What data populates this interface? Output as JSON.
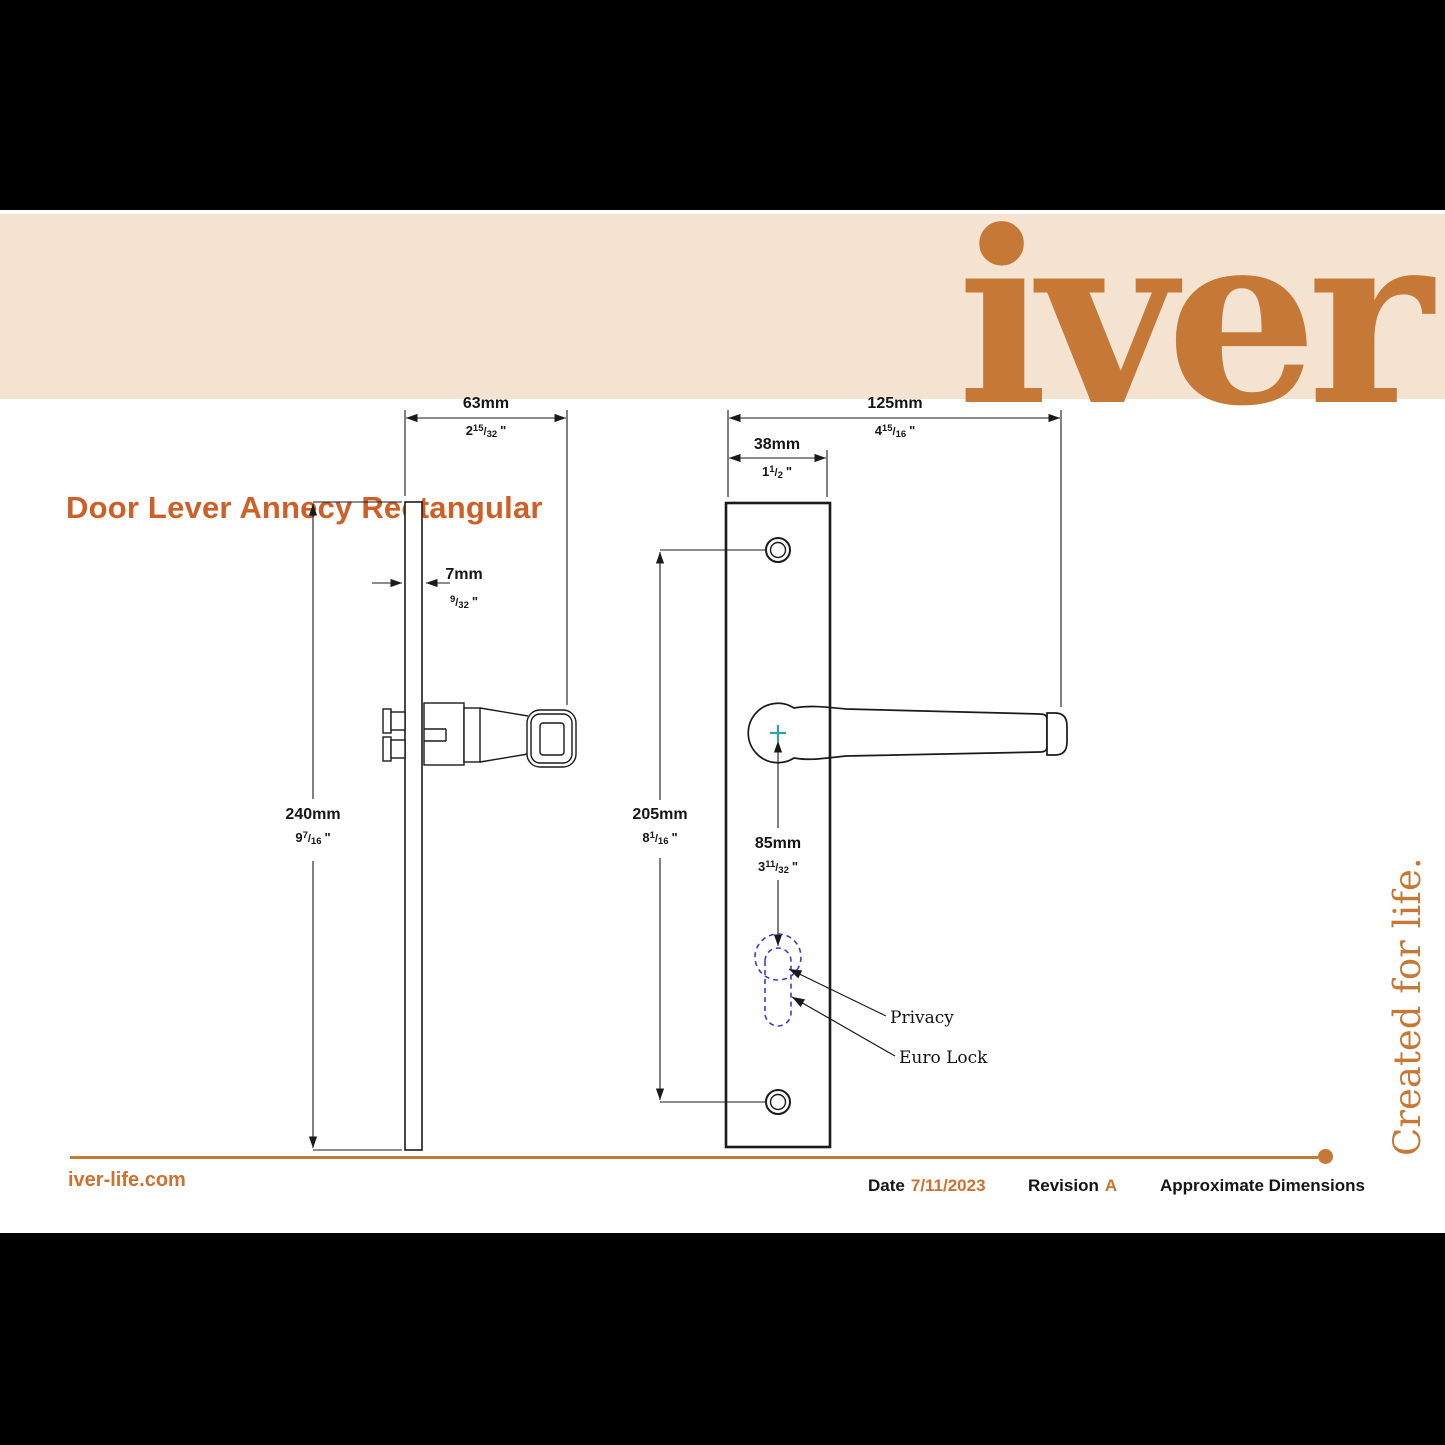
{
  "header": {
    "title": "Door Lever Annecy Rectangular",
    "brand_logo": "iver"
  },
  "tagline": "Created for life.",
  "drawing": {
    "callouts": {
      "privacy": "Privacy",
      "euro_lock": "Euro Lock"
    },
    "dimensions": {
      "d63": {
        "mm": "63mm",
        "in_whole": "2",
        "in_num": "15",
        "in_den": "32"
      },
      "d7": {
        "mm": "7mm",
        "in_whole": "",
        "in_num": "9",
        "in_den": "32"
      },
      "d240": {
        "mm": "240mm",
        "in_whole": "9",
        "in_num": "7",
        "in_den": "16"
      },
      "d125": {
        "mm": "125mm",
        "in_whole": "4",
        "in_num": "15",
        "in_den": "16"
      },
      "d38": {
        "mm": "38mm",
        "in_whole": "1",
        "in_num": "1",
        "in_den": "2"
      },
      "d205": {
        "mm": "205mm",
        "in_whole": "8",
        "in_num": "1",
        "in_den": "16"
      },
      "d85": {
        "mm": "85mm",
        "in_whole": "3",
        "in_num": "11",
        "in_den": "32"
      }
    }
  },
  "footer": {
    "website": "iver-life.com",
    "date_label": "Date",
    "date_value": "7/11/2023",
    "revision_label": "Revision",
    "revision_value": "A",
    "note": "Approximate Dimensions"
  },
  "glyphs": {
    "frac_slash": "/",
    "inch_mark": "\""
  },
  "colors": {
    "accent_orange": "#C67937",
    "title_orange": "#CE5F27",
    "footer_orange": "#CE7030",
    "cream_band": "#F3E3D0",
    "dashed_blue": "#3B3BCC",
    "teal_cross": "#2FA3AC",
    "line_black": "#1A1A1A"
  }
}
